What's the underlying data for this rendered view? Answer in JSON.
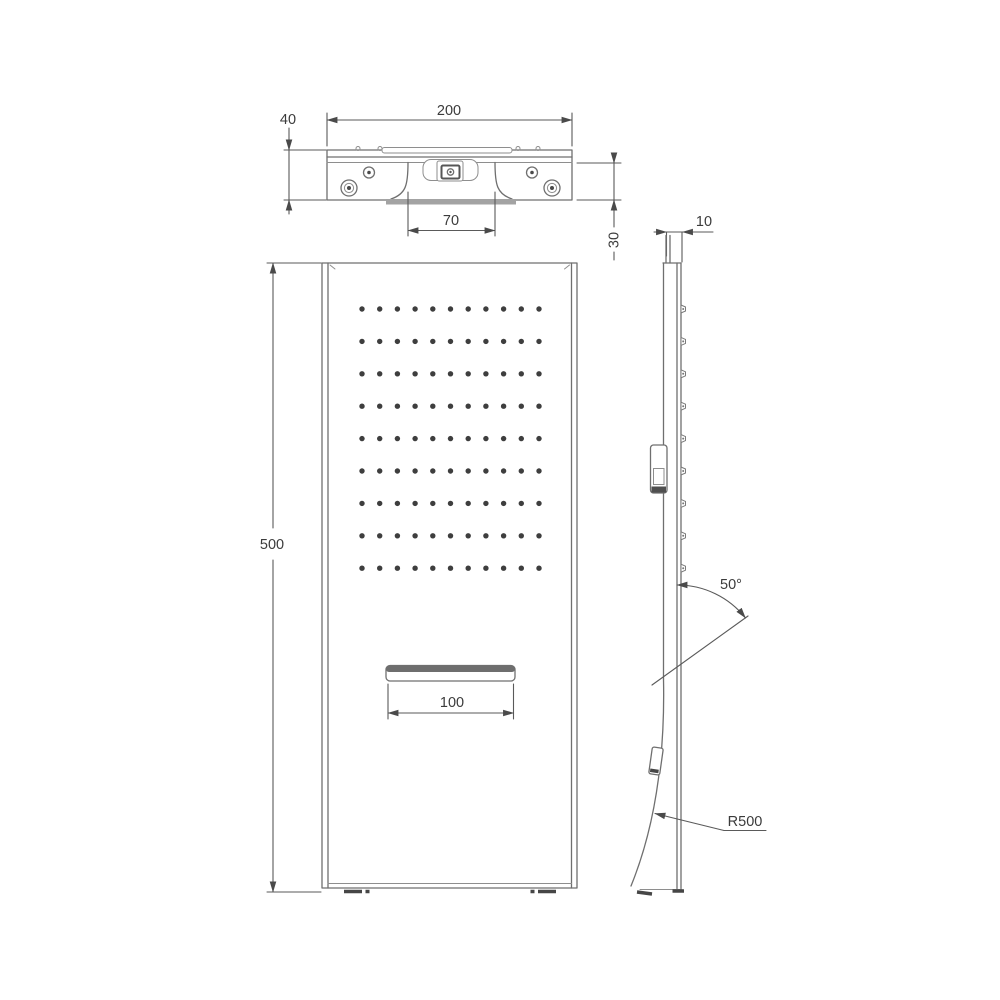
{
  "drawing": {
    "type": "technical-dimension-drawing",
    "subject": "shower-panel",
    "background_color": "#ffffff",
    "line_color": "#6f6f6f",
    "text_color": "#3b3b3b",
    "views": {
      "top_view": {
        "dimensions": {
          "overall_width": "200",
          "overall_depth": "40",
          "recess_width": "70",
          "body_depth": "30"
        }
      },
      "front_view": {
        "dimensions": {
          "overall_height": "500",
          "slot_width": "100"
        },
        "nozzle_grid": {
          "rows": 9,
          "columns": 11
        }
      },
      "side_view": {
        "dimensions": {
          "panel_thickness": "10",
          "spray_angle": "50°",
          "curve_radius": "R500"
        }
      }
    }
  }
}
